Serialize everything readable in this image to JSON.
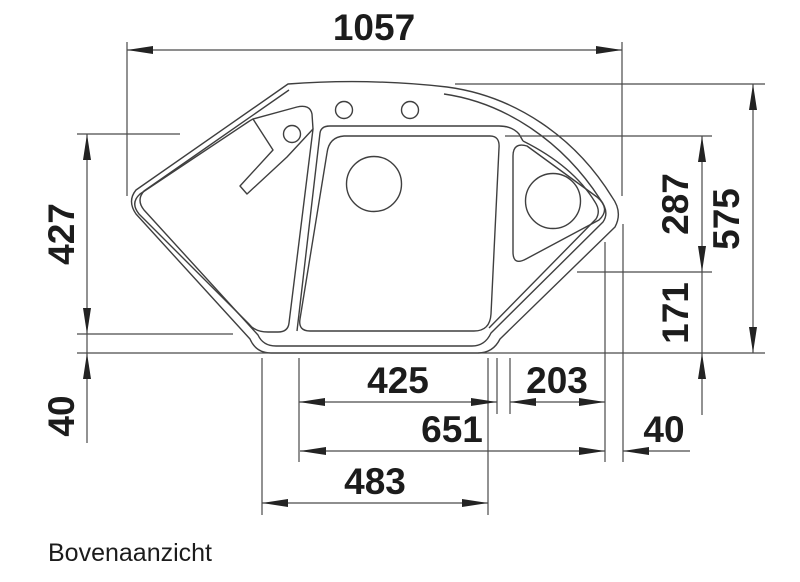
{
  "caption": "Bovenaanzicht",
  "colors": {
    "line": "#3f3f3f",
    "text": "#1c1c1c",
    "background": "#ffffff"
  },
  "dims": {
    "overall_width": "1057",
    "overall_depth": "575",
    "bowl_depth": "427",
    "corner_bowl_depth": "287",
    "front_rim_depth": "171",
    "bottom_left_offset": "40",
    "main_bowl_width": "425",
    "corner_bowl_width": "203",
    "bowls_span": "651",
    "drainer_to_bowl_span": "483",
    "right_offset": "40"
  }
}
